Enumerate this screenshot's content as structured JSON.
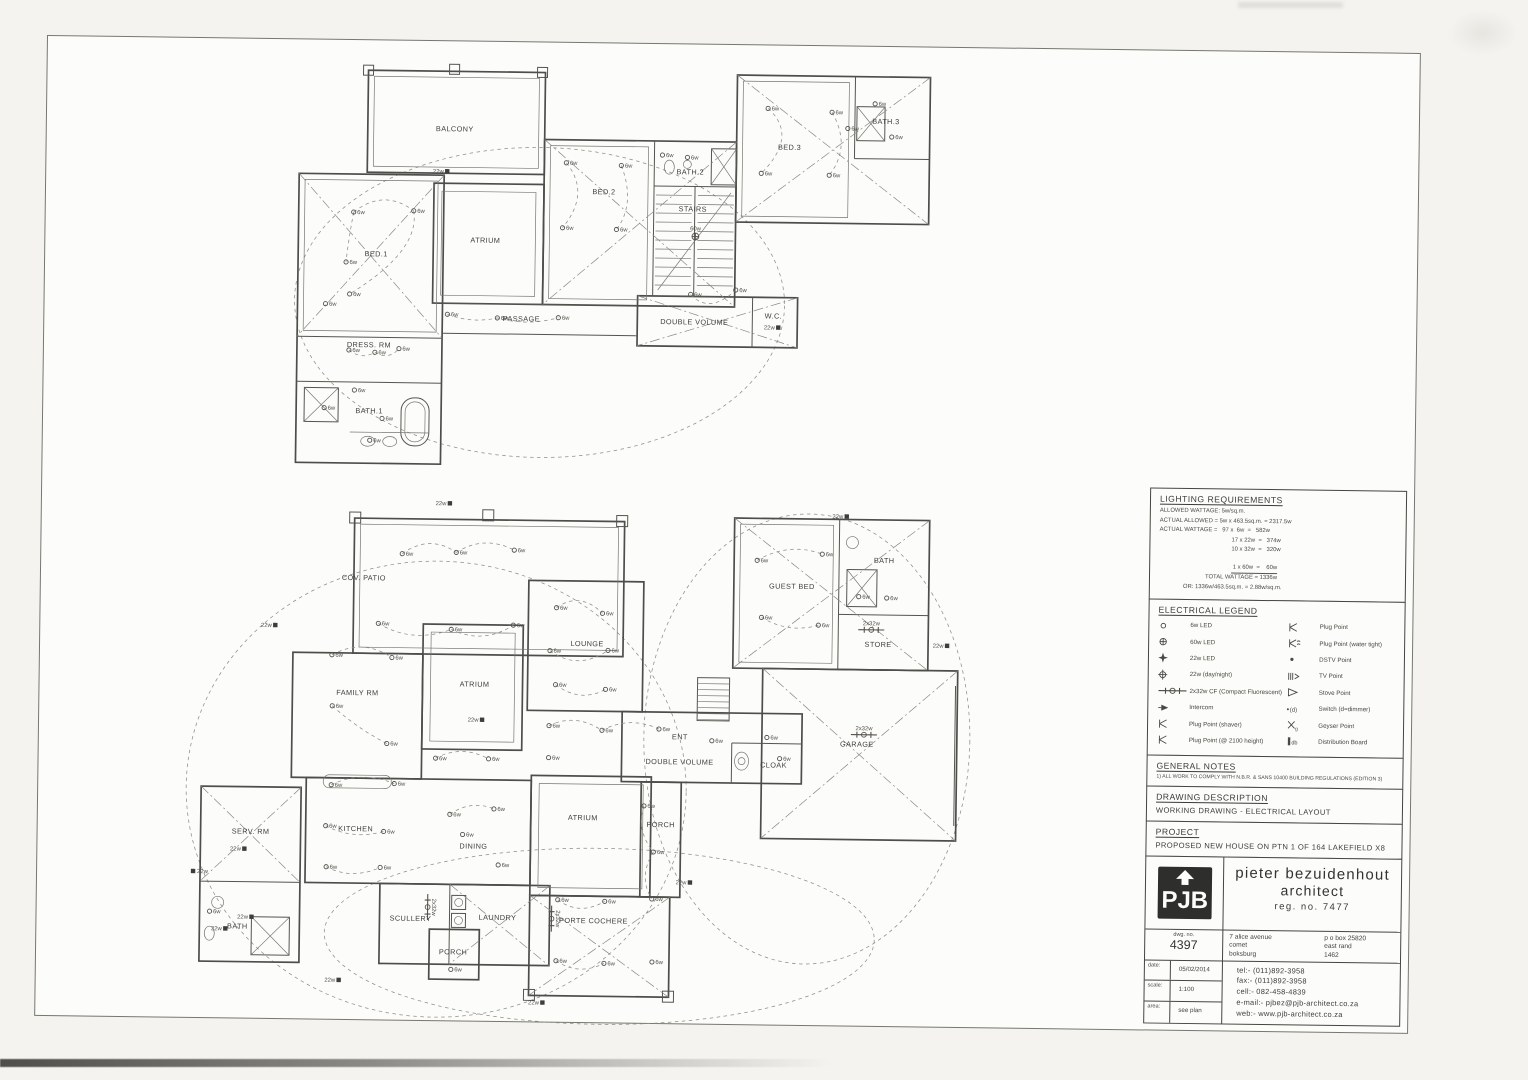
{
  "title_block": {
    "lighting": {
      "heading": "LIGHTING REQUIREMENTS",
      "rows": [
        {
          "t": "ALLOWED WATTAGE: 5w/sq.m.",
          "cls": "l0"
        },
        {
          "t": "ACTUAL ALLOWED = 5w x 463.5sq.m. = 2317.5w",
          "cls": "l0"
        },
        {
          "t": "ACTUAL WATTAGE =   97 x  6w  =   582w",
          "cls": "l0"
        },
        {
          "t": "17 x 22w  =   374w",
          "cls": "l1"
        },
        {
          "t": "10 x 32w  =   320w",
          "cls": "l1"
        },
        {
          "t": " 1 x 60w  =    60w",
          "cls": "l1 sum"
        },
        {
          "t": "TOTAL WATTAGE = 1336w",
          "cls": "l2"
        },
        {
          "t": "OR: 1336w/463.5sq.m. = 2.88w/sq.m.",
          "cls": "l3"
        }
      ]
    },
    "legend": {
      "heading": "ELECTRICAL LEGEND",
      "left": [
        {
          "icon": "led6",
          "label": "6w LED"
        },
        {
          "icon": "led60",
          "label": "60w LED"
        },
        {
          "icon": "led22",
          "label": "22w LED"
        },
        {
          "icon": "daynight",
          "label": "22w (day/night)"
        },
        {
          "icon": "cf",
          "label": "2x32w CF (Compact Fluorescent)"
        },
        {
          "icon": "intercom",
          "label": "Intercom"
        },
        {
          "icon": "plug",
          "label": "Plug Point (shaver)"
        },
        {
          "icon": "plug",
          "label": "Plug Point (@ 2100 height)"
        }
      ],
      "right": [
        {
          "icon": "plug",
          "label": "Plug Point"
        },
        {
          "icon": "plugwt",
          "label": "Plug Point (water tight)"
        },
        {
          "icon": "dstv",
          "label": "DSTV Point"
        },
        {
          "icon": "tv",
          "label": "TV Point"
        },
        {
          "icon": "stove",
          "label": "Stove Point"
        },
        {
          "icon": "switch",
          "glyph": "(d)",
          "label": "Switch (d=dimmer)"
        },
        {
          "icon": "geyser",
          "glyph": "g",
          "label": "Geyser Point"
        },
        {
          "icon": "db",
          "glyph": "db",
          "label": "Distribution Board"
        }
      ]
    },
    "notes": {
      "heading": "GENERAL NOTES",
      "items": [
        "1) ALL WORK TO COMPLY WITH N.B.R. & SANS 10400 BUILDING REGULATIONS (EDITION 3)"
      ]
    },
    "description": {
      "heading": "DRAWING DESCRIPTION",
      "text": "WORKING DRAWING  -  ELECTRICAL LAYOUT"
    },
    "project": {
      "heading": "PROJECT",
      "text": "PROPOSED NEW HOUSE ON PTN 1 OF 164 LAKEFIELD X8"
    },
    "firm": {
      "logo": "PJB",
      "name1": "pieter bezuidenhout",
      "name2": "architect",
      "reg": "reg. no. 7477",
      "dwg_label": "dwg. no.",
      "dwg_no": "4397",
      "address_left": [
        "7 alice avenue",
        "comet",
        "boksburg"
      ],
      "address_right": [
        "p o box 25820",
        "east rand",
        "1462"
      ],
      "meta": [
        {
          "label": "date:",
          "value": "05/02/2014"
        },
        {
          "label": "scale:",
          "value": "1:100"
        },
        {
          "label": "area:",
          "value": "see plan"
        }
      ],
      "contact": [
        "tel:-  (011)892-3958",
        "fax:-  (011)892-3958",
        "cell:-  082-458-4839",
        "e-mail:-  pjbez@pjb-architect.co.za",
        "web:-  www.pjb-architect.co.za"
      ]
    }
  },
  "plans": {
    "upper": {
      "rooms": [
        {
          "l": "BALCONY",
          "x": 163,
          "y": 70
        },
        {
          "l": "BED.1",
          "x": 86,
          "y": 196
        },
        {
          "l": "ATRIUM",
          "x": 195,
          "y": 181
        },
        {
          "l": "BED.2",
          "x": 313,
          "y": 131
        },
        {
          "l": "STAIRS",
          "x": 402,
          "y": 147
        },
        {
          "l": "BATH.2",
          "x": 399,
          "y": 110
        },
        {
          "l": "BED.3",
          "x": 498,
          "y": 84
        },
        {
          "l": "BATH.3",
          "x": 594,
          "y": 57
        },
        {
          "l": "PASSAGE",
          "x": 232,
          "y": 259
        },
        {
          "l": "DOUBLE VOLUME",
          "x": 405,
          "y": 260
        },
        {
          "l": "W.C.",
          "x": 484,
          "y": 253
        },
        {
          "l": "DRESS. RM",
          "x": 80,
          "y": 287
        },
        {
          "l": "BATH.1",
          "x": 81,
          "y": 353
        }
      ],
      "lights": [
        {
          "t": "22w",
          "x": 156,
          "y": 110
        },
        {
          "t": "6w",
          "x": 63,
          "y": 152
        },
        {
          "t": "6w",
          "x": 123,
          "y": 150
        },
        {
          "t": "6w",
          "x": 56,
          "y": 202
        },
        {
          "t": "6w",
          "x": 60,
          "y": 234
        },
        {
          "t": "6w",
          "x": 36,
          "y": 244
        },
        {
          "t": "6w",
          "x": 158,
          "y": 253
        },
        {
          "t": "6w",
          "x": 208,
          "y": 256
        },
        {
          "t": "6w",
          "x": 269,
          "y": 255
        },
        {
          "t": "6w",
          "x": 275,
          "y": 100
        },
        {
          "t": "6w",
          "x": 330,
          "y": 102
        },
        {
          "t": "6w",
          "x": 272,
          "y": 165
        },
        {
          "t": "6w",
          "x": 326,
          "y": 166
        },
        {
          "t": "6w",
          "x": 371,
          "y": 91
        },
        {
          "t": "6w",
          "x": 396,
          "y": 93
        },
        {
          "t": "60w",
          "x": 405,
          "y": 172
        },
        {
          "t": "6w",
          "x": 476,
          "y": 43
        },
        {
          "t": "6w",
          "x": 540,
          "y": 46
        },
        {
          "t": "6w",
          "x": 470,
          "y": 108
        },
        {
          "t": "6w",
          "x": 538,
          "y": 109
        },
        {
          "t": "6w",
          "x": 583,
          "y": 37
        },
        {
          "t": "6w",
          "x": 600,
          "y": 70
        },
        {
          "t": "6w",
          "x": 556,
          "y": 62
        },
        {
          "t": "22w",
          "x": 489,
          "y": 262
        },
        {
          "t": "6w",
          "x": 401,
          "y": 230
        },
        {
          "t": "6w",
          "x": 446,
          "y": 225
        },
        {
          "t": "6w",
          "x": 60,
          "y": 290
        },
        {
          "t": "6w",
          "x": 86,
          "y": 292
        },
        {
          "t": "6w",
          "x": 110,
          "y": 288
        },
        {
          "t": "6w",
          "x": 66,
          "y": 330
        },
        {
          "t": "6w",
          "x": 94,
          "y": 358
        },
        {
          "t": "6w",
          "x": 36,
          "y": 348
        },
        {
          "t": "6w",
          "x": 82,
          "y": 380
        }
      ]
    },
    "lower": {
      "rooms": [
        {
          "l": "COV. PATIO",
          "x": 180,
          "y": 92
        },
        {
          "l": "FAMILY RM",
          "x": 175,
          "y": 207
        },
        {
          "l": "ATRIUM",
          "x": 292,
          "y": 197
        },
        {
          "l": "LOUNGE",
          "x": 404,
          "y": 155
        },
        {
          "l": "GUEST BED",
          "x": 608,
          "y": 95
        },
        {
          "l": "BATH",
          "x": 700,
          "y": 68
        },
        {
          "l": "STORE",
          "x": 695,
          "y": 152
        },
        {
          "l": "GARAGE",
          "x": 675,
          "y": 252
        },
        {
          "l": "ENT",
          "x": 498,
          "y": 247
        },
        {
          "l": "DOUBLE VOLUME",
          "x": 498,
          "y": 272
        },
        {
          "l": "CLOAK",
          "x": 592,
          "y": 274
        },
        {
          "l": "KITCHEN",
          "x": 175,
          "y": 343
        },
        {
          "l": "DINING",
          "x": 293,
          "y": 359
        },
        {
          "l": "SERV. RM",
          "x": 70,
          "y": 347
        },
        {
          "l": "BATH",
          "x": 58,
          "y": 442
        },
        {
          "l": "SCULLERY",
          "x": 231,
          "y": 432
        },
        {
          "l": "LAUNDRY",
          "x": 318,
          "y": 430
        },
        {
          "l": "PORCH",
          "x": 274,
          "y": 465
        },
        {
          "l": "ATRIUM",
          "x": 402,
          "y": 329
        },
        {
          "l": "PORCH",
          "x": 480,
          "y": 335
        },
        {
          "l": "PORTE COCHERE",
          "x": 414,
          "y": 432
        }
      ],
      "lights": [
        {
          "t": "22w",
          "x": 265,
          "y": 14
        },
        {
          "t": "22w",
          "x": 662,
          "y": 22
        },
        {
          "t": "22w",
          "x": 92,
          "y": 138
        },
        {
          "t": "22w",
          "x": 764,
          "y": 150
        },
        {
          "t": "22w",
          "x": 13,
          "y": 385
        },
        {
          "t": "22w",
          "x": 64,
          "y": 362
        },
        {
          "t": "22w",
          "x": 72,
          "y": 430
        },
        {
          "t": "22w",
          "x": 46,
          "y": 442
        },
        {
          "t": "22w",
          "x": 160,
          "y": 492
        },
        {
          "t": "22w",
          "x": 364,
          "y": 512
        },
        {
          "t": "22w",
          "x": 300,
          "y": 230
        },
        {
          "t": "22w",
          "x": 510,
          "y": 390
        },
        {
          "t": "2x32w",
          "x": 688,
          "y": 135
        },
        {
          "t": "2x32w",
          "x": 682,
          "y": 240
        },
        {
          "t": "2x32w",
          "x": 248,
          "y": 418,
          "v": 1
        },
        {
          "t": "2x32w",
          "x": 372,
          "y": 428,
          "v": 1
        },
        {
          "t": "6w",
          "x": 218,
          "y": 65
        },
        {
          "t": "6w",
          "x": 272,
          "y": 63
        },
        {
          "t": "6w",
          "x": 330,
          "y": 60
        },
        {
          "t": "6w",
          "x": 195,
          "y": 135
        },
        {
          "t": "6w",
          "x": 268,
          "y": 140
        },
        {
          "t": "6w",
          "x": 330,
          "y": 135
        },
        {
          "t": "6w",
          "x": 149,
          "y": 167
        },
        {
          "t": "6w",
          "x": 209,
          "y": 169
        },
        {
          "t": "6w",
          "x": 150,
          "y": 218
        },
        {
          "t": "6w",
          "x": 205,
          "y": 255
        },
        {
          "t": "6w",
          "x": 373,
          "y": 117
        },
        {
          "t": "6w",
          "x": 419,
          "y": 122
        },
        {
          "t": "6w",
          "x": 367,
          "y": 160
        },
        {
          "t": "6w",
          "x": 425,
          "y": 159
        },
        {
          "t": "6w",
          "x": 373,
          "y": 194
        },
        {
          "t": "6w",
          "x": 423,
          "y": 198
        },
        {
          "t": "6w",
          "x": 573,
          "y": 67
        },
        {
          "t": "6w",
          "x": 638,
          "y": 60
        },
        {
          "t": "6w",
          "x": 578,
          "y": 124
        },
        {
          "t": "6w",
          "x": 635,
          "y": 131
        },
        {
          "t": "6w",
          "x": 675,
          "y": 102
        },
        {
          "t": "6w",
          "x": 703,
          "y": 103
        },
        {
          "t": "6w",
          "x": 367,
          "y": 235
        },
        {
          "t": "6w",
          "x": 420,
          "y": 239
        },
        {
          "t": "6w",
          "x": 477,
          "y": 237
        },
        {
          "t": "6w",
          "x": 530,
          "y": 248
        },
        {
          "t": "6w",
          "x": 585,
          "y": 244
        },
        {
          "t": "6w",
          "x": 367,
          "y": 267
        },
        {
          "t": "6w",
          "x": 598,
          "y": 265
        },
        {
          "t": "6w",
          "x": 150,
          "y": 297
        },
        {
          "t": "6w",
          "x": 213,
          "y": 295
        },
        {
          "t": "6w",
          "x": 145,
          "y": 338
        },
        {
          "t": "6w",
          "x": 203,
          "y": 343
        },
        {
          "t": "6w",
          "x": 146,
          "y": 379
        },
        {
          "t": "6w",
          "x": 200,
          "y": 379
        },
        {
          "t": "6w",
          "x": 254,
          "y": 269
        },
        {
          "t": "6w",
          "x": 307,
          "y": 269
        },
        {
          "t": "6w",
          "x": 269,
          "y": 325
        },
        {
          "t": "6w",
          "x": 313,
          "y": 319
        },
        {
          "t": "6w",
          "x": 282,
          "y": 345
        },
        {
          "t": "6w",
          "x": 318,
          "y": 375
        },
        {
          "t": "6w",
          "x": 463,
          "y": 314
        },
        {
          "t": "6w",
          "x": 473,
          "y": 360
        },
        {
          "t": "6w",
          "x": 472,
          "y": 407
        },
        {
          "t": "6w",
          "x": 473,
          "y": 470
        },
        {
          "t": "6w",
          "x": 378,
          "y": 409
        },
        {
          "t": "6w",
          "x": 425,
          "y": 410
        },
        {
          "t": "6w",
          "x": 377,
          "y": 470
        },
        {
          "t": "6w",
          "x": 425,
          "y": 472
        },
        {
          "t": "6w",
          "x": 30,
          "y": 425
        },
        {
          "t": "6w",
          "x": 272,
          "y": 480
        }
      ]
    }
  }
}
